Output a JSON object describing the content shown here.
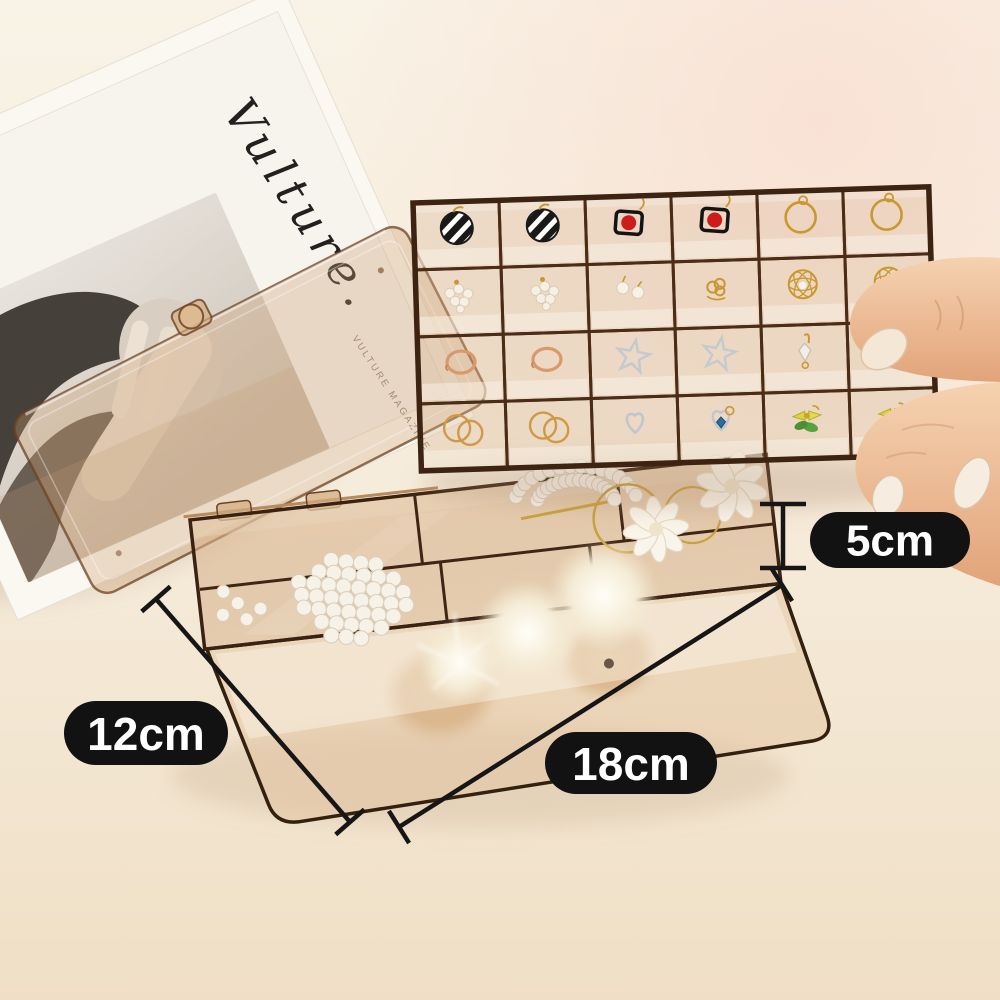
{
  "image": {
    "type": "product-photo",
    "subject": "transparent amber acrylic jewelry organizer box with removable 24-grid earring tray held by a hand"
  },
  "annotations": {
    "height": {
      "label": "5cm"
    },
    "width": {
      "label": "12cm"
    },
    "length": {
      "label": "18cm"
    }
  },
  "magazine": {
    "title": "Vulture.",
    "spine_text": "VULTURE MAGAZINE"
  },
  "tray": {
    "rows": 4,
    "cols": 6,
    "items": [
      "earring-striped-hoop",
      "earring-striped-hoop",
      "earring-red-square",
      "earring-red-square",
      "earring-gold-hoop",
      "earring-gold-hoop",
      "earring-pearl-cluster",
      "earring-pearl-cluster",
      "earring-pearl-stud",
      "earring-gold-knot",
      "earring-gold-wire-ball",
      "earring-gold-wire-ball",
      "ring-rose-gold",
      "ring-rose-gold",
      "earring-silver-star",
      "earring-silver-star",
      "earring-gold-crystal",
      "earring-gold-flower",
      "earring-gold-hoops-pair",
      "earring-gold-hoops-pair",
      "earring-silver-heart",
      "earring-blue-gem-heart",
      "earring-yellow-bow",
      "earring-yellow-bow"
    ]
  },
  "base_box": {
    "contents": [
      "pearl-barrette",
      "pearl-barrette",
      "loose-pearls",
      "gold-hoop",
      "flower-hair-tie",
      "flower-hair-tie",
      "fur-pompom",
      "fur-pompom",
      "white-fur-pompom",
      "tan-scrunchie",
      "tan-scrunchie"
    ]
  },
  "hand": {
    "position": "right",
    "holding": "earring-tray-corner"
  },
  "colors": {
    "background": "#f6eedd",
    "label_bg": "#121212",
    "label_text": "#ffffff",
    "dimension_line": "#161616",
    "acrylic_tint": "#c49a6b",
    "frame_line": "#422814",
    "gold": "#c9982f",
    "rose_gold": "#d8996b",
    "silver": "#c2c9d0",
    "pearl": "#f6f0e6",
    "red_accent": "#ce1b1b",
    "blue_gem": "#2a6d9e",
    "bow_yellow": "#ddd23f",
    "leaf_green": "#4f9c3c",
    "skin": "#eec2a0"
  }
}
